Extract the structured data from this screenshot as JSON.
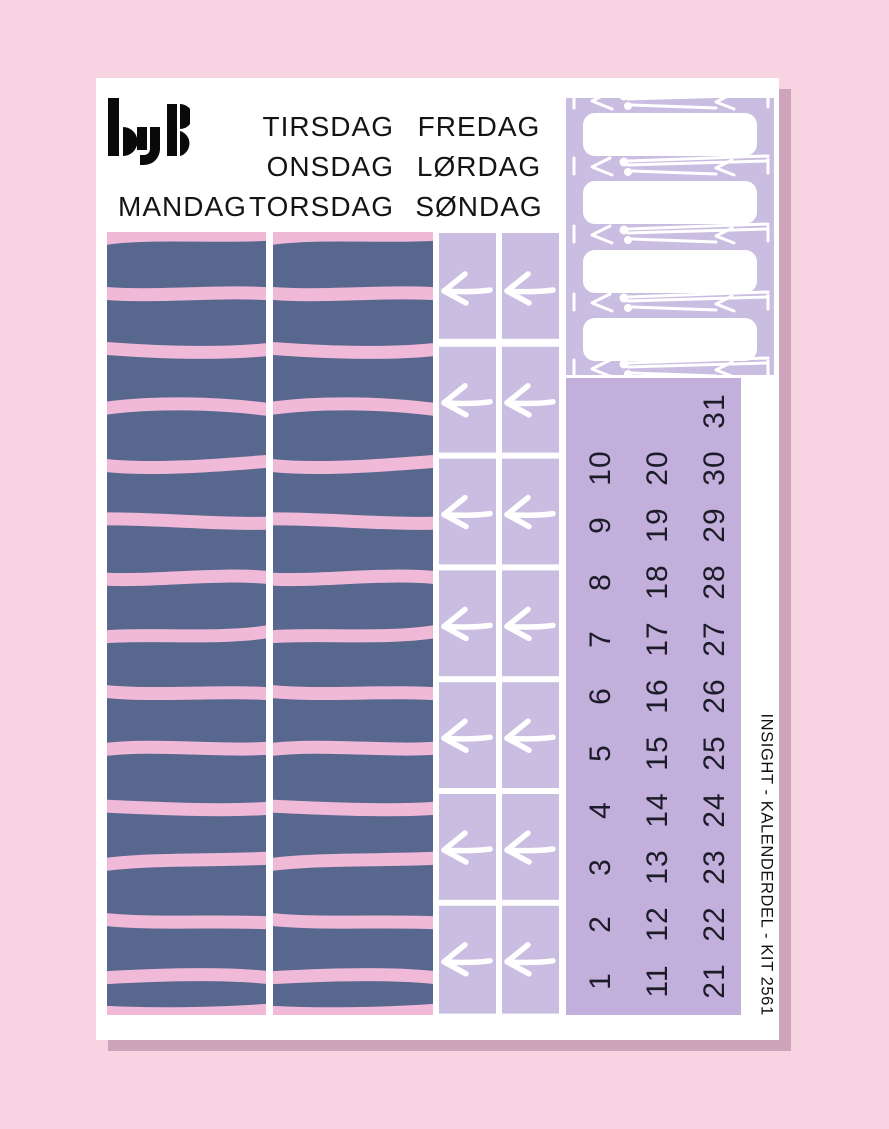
{
  "brand": {
    "logo_text": "byB"
  },
  "day_labels": {
    "monday": "MANDAG",
    "tuesday": "TIRSDAG",
    "wednesday": "ONSDAG",
    "thursday": "TORSDAG",
    "friday": "FREDAG",
    "saturday": "LØRDAG",
    "sunday": "SØNDAG"
  },
  "date_numbers": [
    "1",
    "2",
    "3",
    "4",
    "5",
    "6",
    "7",
    "8",
    "9",
    "10",
    "11",
    "12",
    "13",
    "14",
    "15",
    "16",
    "17",
    "18",
    "19",
    "20",
    "21",
    "22",
    "23",
    "24",
    "25",
    "26",
    "27",
    "28",
    "29",
    "30",
    "31"
  ],
  "kit_label": "INSIGHT - KALENDERDEL - KIT 2561",
  "colors": {
    "background": "#f8d3e2",
    "sheet_shadow": "#cda4ba",
    "sheet": "#ffffff",
    "washi_base": "#57678e",
    "washi_stripe": "#f1b9d8",
    "lavender": "#cabde2",
    "numbers_block": "#c2afdc",
    "doodle_white": "#ffffff",
    "text": "#141414"
  }
}
